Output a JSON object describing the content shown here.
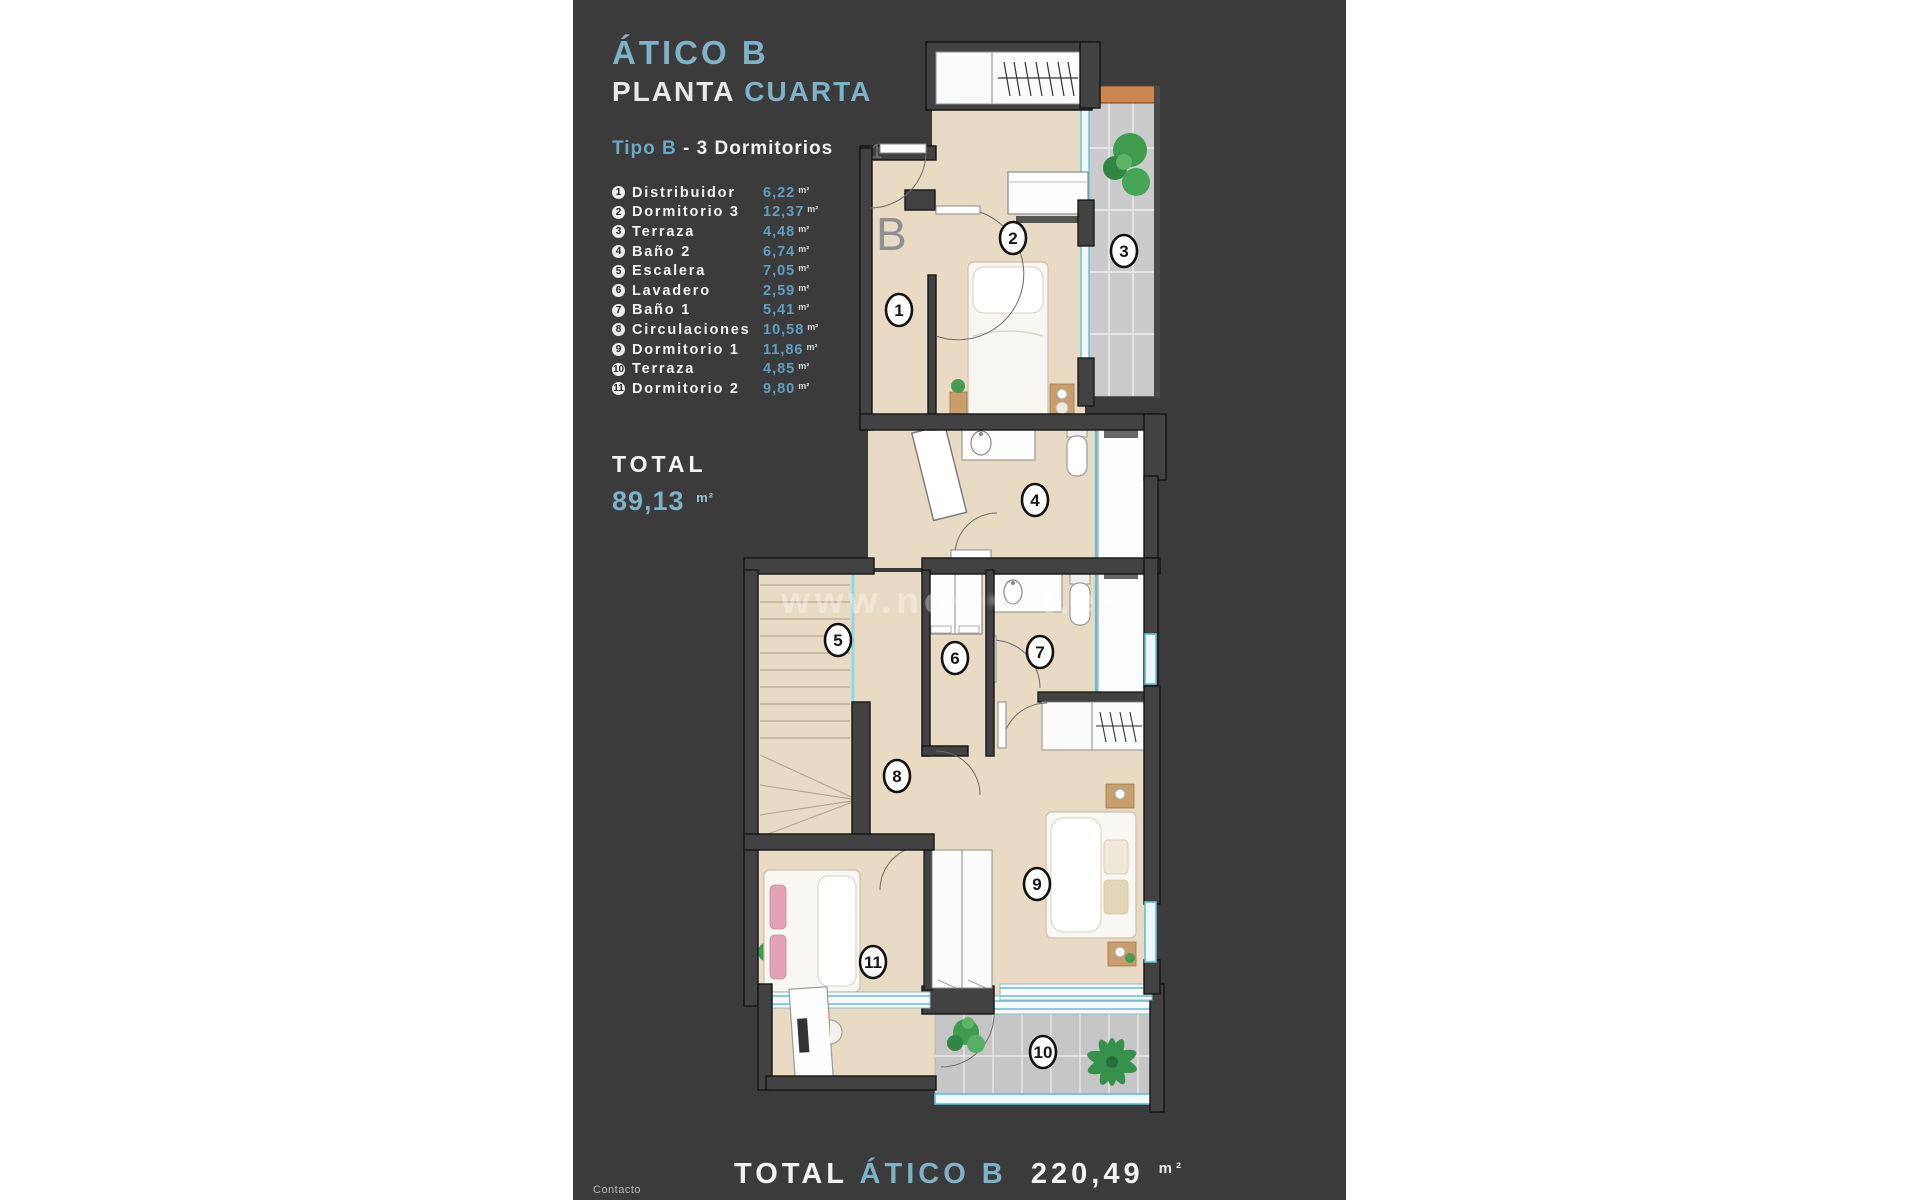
{
  "header": {
    "title": "ÁTICO B",
    "subtitle_white": "PLANTA",
    "subtitle_accent": "CUARTA",
    "type_accent": "Tipo B",
    "type_rest": "- 3 Dormitorios"
  },
  "rooms": [
    {
      "num": "1",
      "name": "Distribuidor",
      "area": "6,22"
    },
    {
      "num": "2",
      "name": "Dormitorio 3",
      "area": "12,37"
    },
    {
      "num": "3",
      "name": "Terraza",
      "area": "4,48"
    },
    {
      "num": "4",
      "name": "Baño 2",
      "area": "6,74"
    },
    {
      "num": "5",
      "name": "Escalera",
      "area": "7,05"
    },
    {
      "num": "6",
      "name": "Lavadero",
      "area": "2,59"
    },
    {
      "num": "7",
      "name": "Baño 1",
      "area": "5,41"
    },
    {
      "num": "8",
      "name": "Circulaciones",
      "area": "10,58"
    },
    {
      "num": "9",
      "name": "Dormitorio 1",
      "area": "11,86"
    },
    {
      "num": "10",
      "name": "Terraza",
      "area": "4,85"
    },
    {
      "num": "11",
      "name": "Dormitorio 2",
      "area": "9,80"
    }
  ],
  "area_unit": "m²",
  "total": {
    "label": "TOTAL",
    "value": "89,13"
  },
  "watermark": {
    "prefix": "www.no",
    "obscured": "•••••",
    "suffix": "t.es"
  },
  "footer": {
    "contact": "Contacto",
    "total_label": "TOTAL",
    "total_name": "ÁTICO B",
    "total_value": "220,49"
  },
  "plan": {
    "block_letter": "B",
    "faint_number": "1"
  },
  "colors": {
    "panel": "#3b3b3b",
    "accent": "#7eb2c8",
    "value_blue": "#5f9fc0",
    "floor": "#e9dac4",
    "wall": "#424242",
    "tile": "#cbcbcb",
    "glass": "#5fc0d6",
    "wood": "#cd8650",
    "plant": "#4a9b52"
  }
}
